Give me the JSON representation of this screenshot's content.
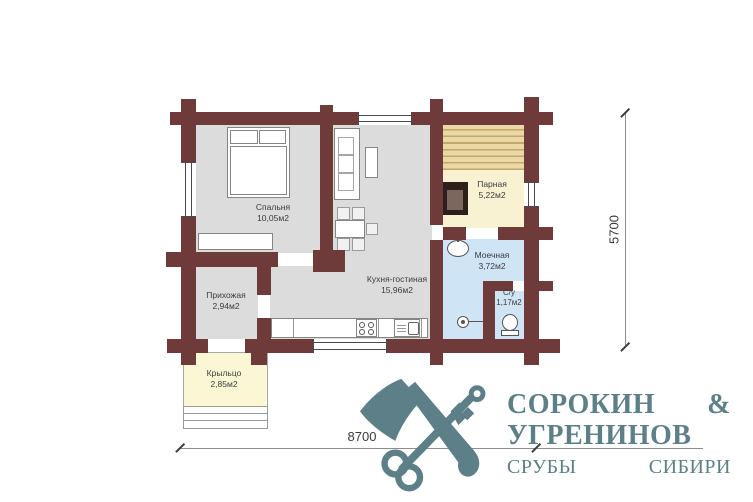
{
  "plan": {
    "rooms": [
      {
        "name": "Спальня",
        "area": "10,05м2"
      },
      {
        "name": "Кухня-гостиная",
        "area": "15,96м2"
      },
      {
        "name": "Прихожая",
        "area": "2,94м2"
      },
      {
        "name": "Парная",
        "area": "5,22м2"
      },
      {
        "name": "Моечная",
        "area": "3,72м2"
      },
      {
        "name": "С/у",
        "area": "1,17м2"
      },
      {
        "name": "Крыльцо",
        "area": "2,85м2"
      }
    ],
    "dimensions": {
      "width": "8700",
      "height": "5700"
    },
    "colors": {
      "wall": "#6e3a3a",
      "floor": "#dcdcdc",
      "wet": "#cfe5f6",
      "sauna": "#f8f2d3",
      "porch": "#fbf6d3",
      "logo": "#5d7f87"
    }
  },
  "logo": {
    "line1": "СОРОКИН &",
    "line2": "УГРЕНИНОВ",
    "line3": "СРУБЫ СИБИРИ"
  }
}
